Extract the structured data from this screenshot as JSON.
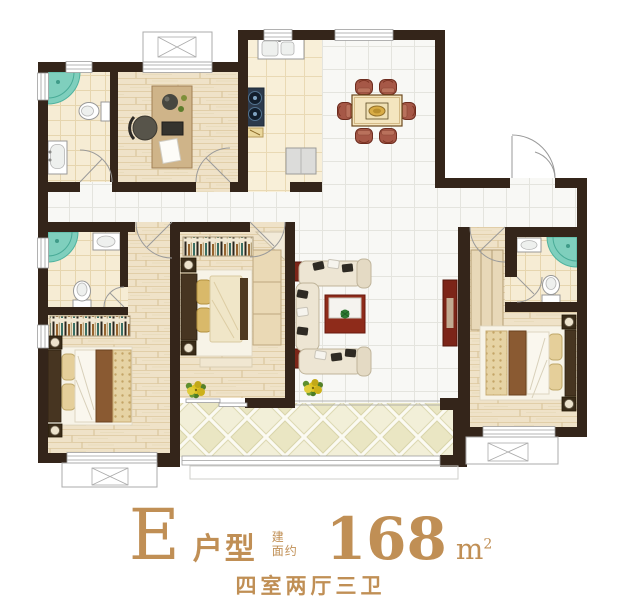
{
  "floor_plan": {
    "unit_letter": "E",
    "unit_type_label": "户型",
    "area_label_line1": "建",
    "area_label_line2": "面约",
    "area_value": "168",
    "area_unit": "m",
    "area_unit_exponent": "2",
    "layout_summary": "四室两厅三卫"
  },
  "colors": {
    "accent_gold": "#c08f55",
    "wall_dark": "#34251a",
    "shower_teal": "#7fcfbd",
    "shower_teal_deep": "#4fb3a0",
    "accent_red": "#7c2518",
    "rug_red": "#8e2b1a",
    "wood_light": "#efe2c8",
    "tile_white": "#f8f8f5",
    "cream_tile": "#f8efd8",
    "balcony_tile": "#eae6c3",
    "sofa_cream": "#ede5d3",
    "chair_brown": "#a65847",
    "blanket_brown": "#8a5a32"
  }
}
